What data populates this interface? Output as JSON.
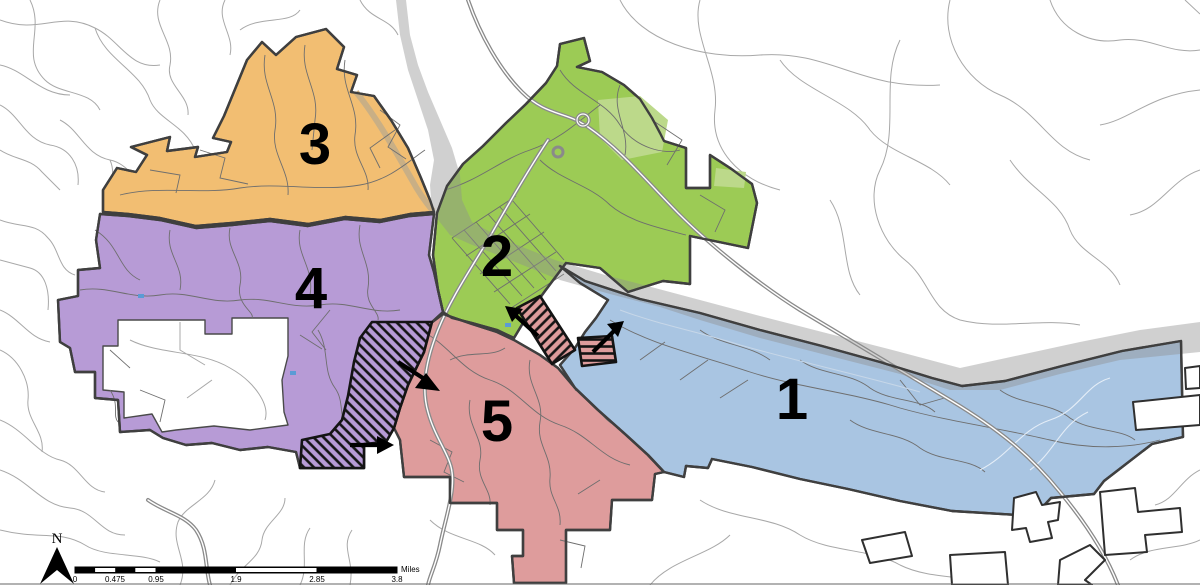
{
  "districts": [
    {
      "label": "3",
      "color": "#F2BE72"
    },
    {
      "label": "2",
      "color": "#9CCB55"
    },
    {
      "label": "4",
      "color": "#B79BD6"
    },
    {
      "label": "5",
      "color": "#DE9C9C"
    },
    {
      "label": "1",
      "color": "#A9C5E2"
    }
  ],
  "scale_bar": {
    "ticks": [
      "0",
      "0.475",
      "0.95",
      "1.9",
      "2.85",
      "3.8"
    ],
    "unit_label": "Miles"
  },
  "north_arrow": {
    "label": "N"
  },
  "annotations": {
    "hatched_area_count": 3,
    "transfer_arrow_count": 4
  },
  "colors": {
    "river": "#C9C9C9",
    "district_boundary": "#3F3F3F",
    "hatch_lines": "#141414",
    "arrows": "#000000",
    "roads_outside": "#A8A8A8",
    "roads_inside": "#6E6E6E"
  }
}
